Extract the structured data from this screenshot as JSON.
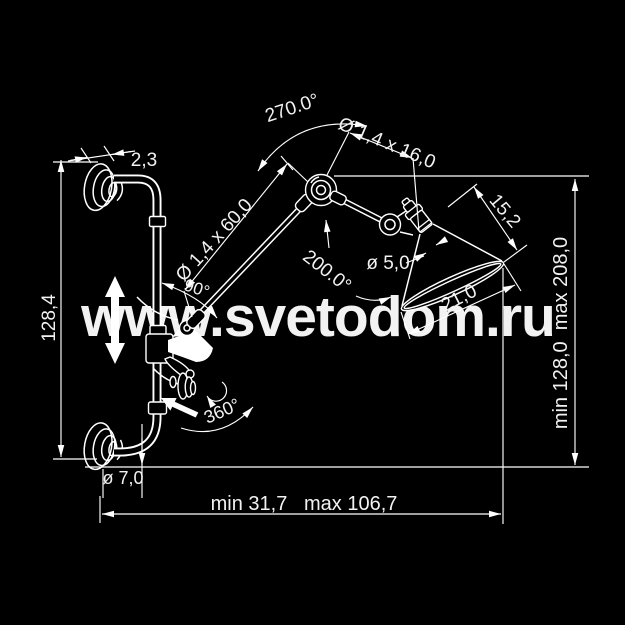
{
  "canvas": {
    "background": "#000000",
    "line_color": "#ffffff"
  },
  "watermark": {
    "text": "www.svetodom.ru",
    "color": "#200d07"
  },
  "dimensions": {
    "flange_thickness": "2,3",
    "bracket_height": "128,4",
    "flange_diameter": "ø 7,0",
    "horizontal_extent": "min 31,7   max 106,7",
    "vertical_extent": "min 128,0  max 208,0",
    "upper_joint_rotation": "270.0°",
    "lower_arm_tube": "Ø 1,4 x 60,0",
    "upper_arm_tube": "Ø 1,4 x 16,0",
    "arm_angle": "90°",
    "head_joint_rotation": "200.0°",
    "socket_tube_diameter": "ø 5,0",
    "shade_slant_height": "15,2",
    "shade_opening_width": "21,0",
    "swivel_rotation": "360°"
  }
}
